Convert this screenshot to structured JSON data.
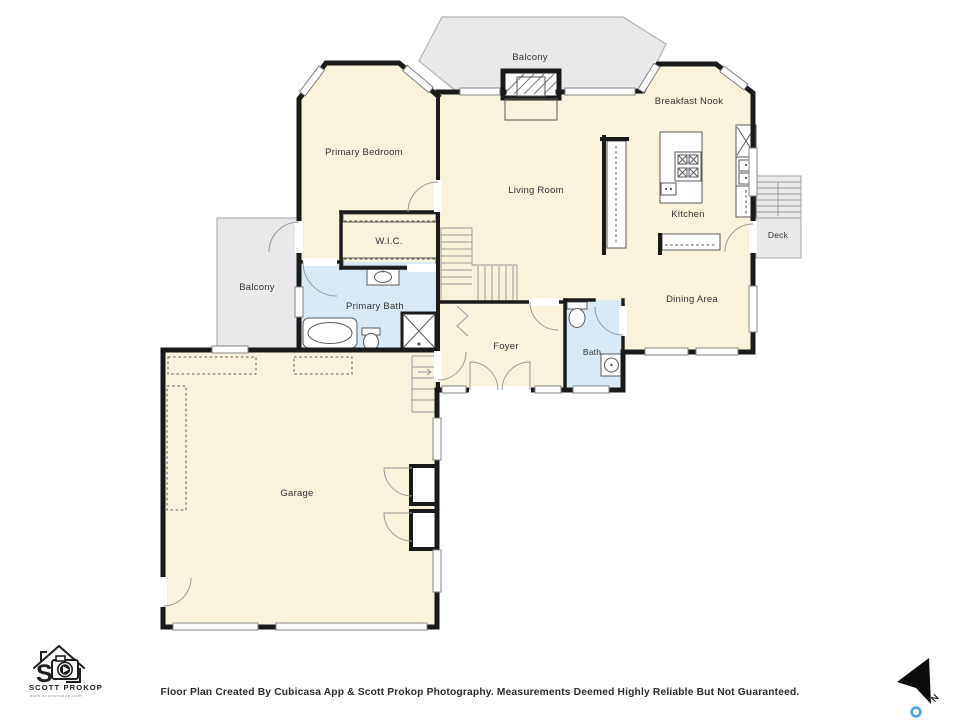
{
  "floorplan": {
    "rooms": [
      {
        "id": "balcony-top",
        "label": "Balcony"
      },
      {
        "id": "primary-bedroom",
        "label": "Primary Bedroom"
      },
      {
        "id": "breakfast-nook",
        "label": "Breakfast Nook"
      },
      {
        "id": "living-room",
        "label": "Living Room"
      },
      {
        "id": "kitchen",
        "label": "Kitchen"
      },
      {
        "id": "deck",
        "label": "Deck"
      },
      {
        "id": "wic",
        "label": "W.I.C."
      },
      {
        "id": "balcony-left",
        "label": "Balcony"
      },
      {
        "id": "primary-bath",
        "label": "Primary Bath"
      },
      {
        "id": "foyer",
        "label": "Foyer"
      },
      {
        "id": "bath",
        "label": "Bath"
      },
      {
        "id": "dining-area",
        "label": "Dining Area"
      },
      {
        "id": "garage",
        "label": "Garage"
      }
    ],
    "symbols": [
      "bathtub",
      "shower",
      "toilet",
      "sink",
      "stove",
      "kitchen-island",
      "fireplace",
      "staircase",
      "door-swing",
      "window",
      "closet-shelving",
      "deck-stairs"
    ],
    "colors": {
      "interior": "#FAF3DB",
      "wet_room": "#D9E9F6",
      "outdoor": "#E9E9EB",
      "wall": "#1A1A1A",
      "label_text": "#333333",
      "compass_pin_blue": "#45A6E5"
    }
  },
  "branding": {
    "logo_name": "SCOTT PROKOP",
    "logo_website": "www.scottprokop.com"
  },
  "compass": {
    "north_label": "N"
  },
  "footer": {
    "disclaimer": "Floor Plan Created By Cubicasa App & Scott Prokop Photography. Measurements Deemed Highly Reliable But Not Guaranteed."
  }
}
